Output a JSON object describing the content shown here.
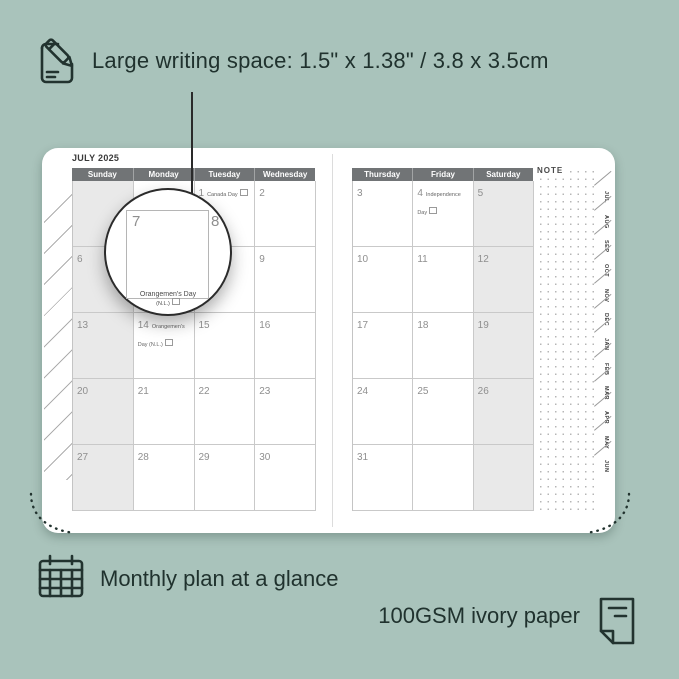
{
  "colors": {
    "background": "#a9c3bb",
    "ink": "#20322e",
    "header_bar": "#717476",
    "header_text": "#ffffff",
    "shaded_column": "#e9e9e9",
    "grid_line": "#c9c9c9",
    "day_number": "#8f8f8f"
  },
  "annotations": {
    "top_feature": "Large writing space: 1.5\" x 1.38\" / 3.8 x 3.5cm",
    "bottom_feature": "Monthly plan at a glance",
    "paper_feature": "100GSM ivory paper"
  },
  "planner": {
    "month_title": "JULY 2025",
    "note_label": "NOTE",
    "weekdays_left": [
      "Sunday",
      "Monday",
      "Tuesday",
      "Wednesday"
    ],
    "weekdays_right": [
      "Thursday",
      "Friday",
      "Saturday"
    ],
    "cells_left": [
      {
        "day": "",
        "holiday": "",
        "shaded": true
      },
      {
        "day": "",
        "holiday": "",
        "shaded": false
      },
      {
        "day": "1",
        "holiday": "Canada Day",
        "shaded": false
      },
      {
        "day": "2",
        "holiday": "",
        "shaded": false
      },
      {
        "day": "6",
        "holiday": "",
        "shaded": true
      },
      {
        "day": "7",
        "holiday": "",
        "shaded": false
      },
      {
        "day": "8",
        "holiday": "",
        "shaded": false
      },
      {
        "day": "9",
        "holiday": "",
        "shaded": false
      },
      {
        "day": "13",
        "holiday": "",
        "shaded": true
      },
      {
        "day": "14",
        "holiday": "Orangemen's Day (N.L.)",
        "shaded": false
      },
      {
        "day": "15",
        "holiday": "",
        "shaded": false
      },
      {
        "day": "16",
        "holiday": "",
        "shaded": false
      },
      {
        "day": "20",
        "holiday": "",
        "shaded": true
      },
      {
        "day": "21",
        "holiday": "",
        "shaded": false
      },
      {
        "day": "22",
        "holiday": "",
        "shaded": false
      },
      {
        "day": "23",
        "holiday": "",
        "shaded": false
      },
      {
        "day": "27",
        "holiday": "",
        "shaded": true
      },
      {
        "day": "28",
        "holiday": "",
        "shaded": false
      },
      {
        "day": "29",
        "holiday": "",
        "shaded": false
      },
      {
        "day": "30",
        "holiday": "",
        "shaded": false
      }
    ],
    "cells_right": [
      {
        "day": "3",
        "holiday": "",
        "shaded": false
      },
      {
        "day": "4",
        "holiday": "Independence Day",
        "shaded": false
      },
      {
        "day": "5",
        "holiday": "",
        "shaded": true
      },
      {
        "day": "10",
        "holiday": "",
        "shaded": false
      },
      {
        "day": "11",
        "holiday": "",
        "shaded": false
      },
      {
        "day": "12",
        "holiday": "",
        "shaded": true
      },
      {
        "day": "17",
        "holiday": "",
        "shaded": false
      },
      {
        "day": "18",
        "holiday": "",
        "shaded": false
      },
      {
        "day": "19",
        "holiday": "",
        "shaded": true
      },
      {
        "day": "24",
        "holiday": "",
        "shaded": false
      },
      {
        "day": "25",
        "holiday": "",
        "shaded": false
      },
      {
        "day": "26",
        "holiday": "",
        "shaded": true
      },
      {
        "day": "31",
        "holiday": "",
        "shaded": false
      },
      {
        "day": "",
        "holiday": "",
        "shaded": false
      },
      {
        "day": "",
        "holiday": "",
        "shaded": true
      }
    ],
    "month_tabs": [
      "JUL",
      "AUG",
      "SEP",
      "OCT",
      "NOV",
      "DEC",
      "JAN",
      "FEB",
      "MAR",
      "APR",
      "MAY",
      "JUN"
    ],
    "magnifier": {
      "day_left": "7",
      "day_right": "8",
      "holiday_line1": "Orangemen's Day",
      "holiday_line2": "(N.L.)"
    }
  }
}
